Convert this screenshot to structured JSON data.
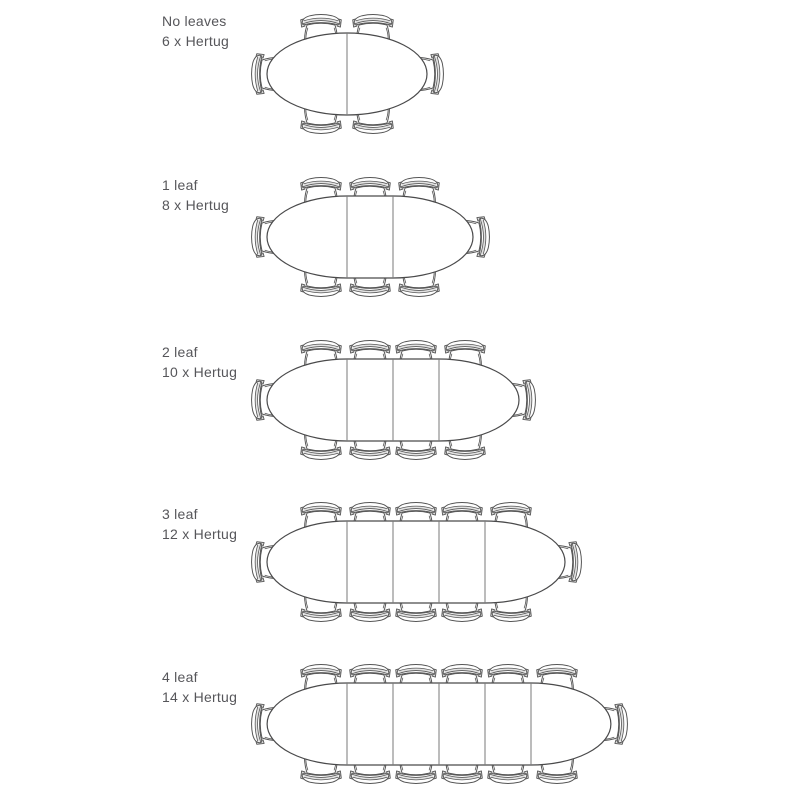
{
  "chair_model": "Hertug",
  "colors": {
    "background": "#ffffff",
    "table_outline": "#4a4a4b",
    "chair_outline": "#565656",
    "leaf_divider": "#7a7a7a",
    "chair_shading": "#dcdcdc",
    "text": "#56565a"
  },
  "rows": [
    {
      "label": "No leaves",
      "seats_label": "6 x Hertug",
      "leaves": 0,
      "seats": 6
    },
    {
      "label": "1 leaf",
      "seats_label": "8 x Hertug",
      "leaves": 1,
      "seats": 8
    },
    {
      "label": "2 leaf",
      "seats_label": "10 x Hertug",
      "leaves": 2,
      "seats": 10
    },
    {
      "label": "3 leaf",
      "seats_label": "12 x Hertug",
      "leaves": 3,
      "seats": 12
    },
    {
      "label": "4 leaf",
      "seats_label": "14 x Hertug",
      "leaves": 4,
      "seats": 14
    }
  ]
}
